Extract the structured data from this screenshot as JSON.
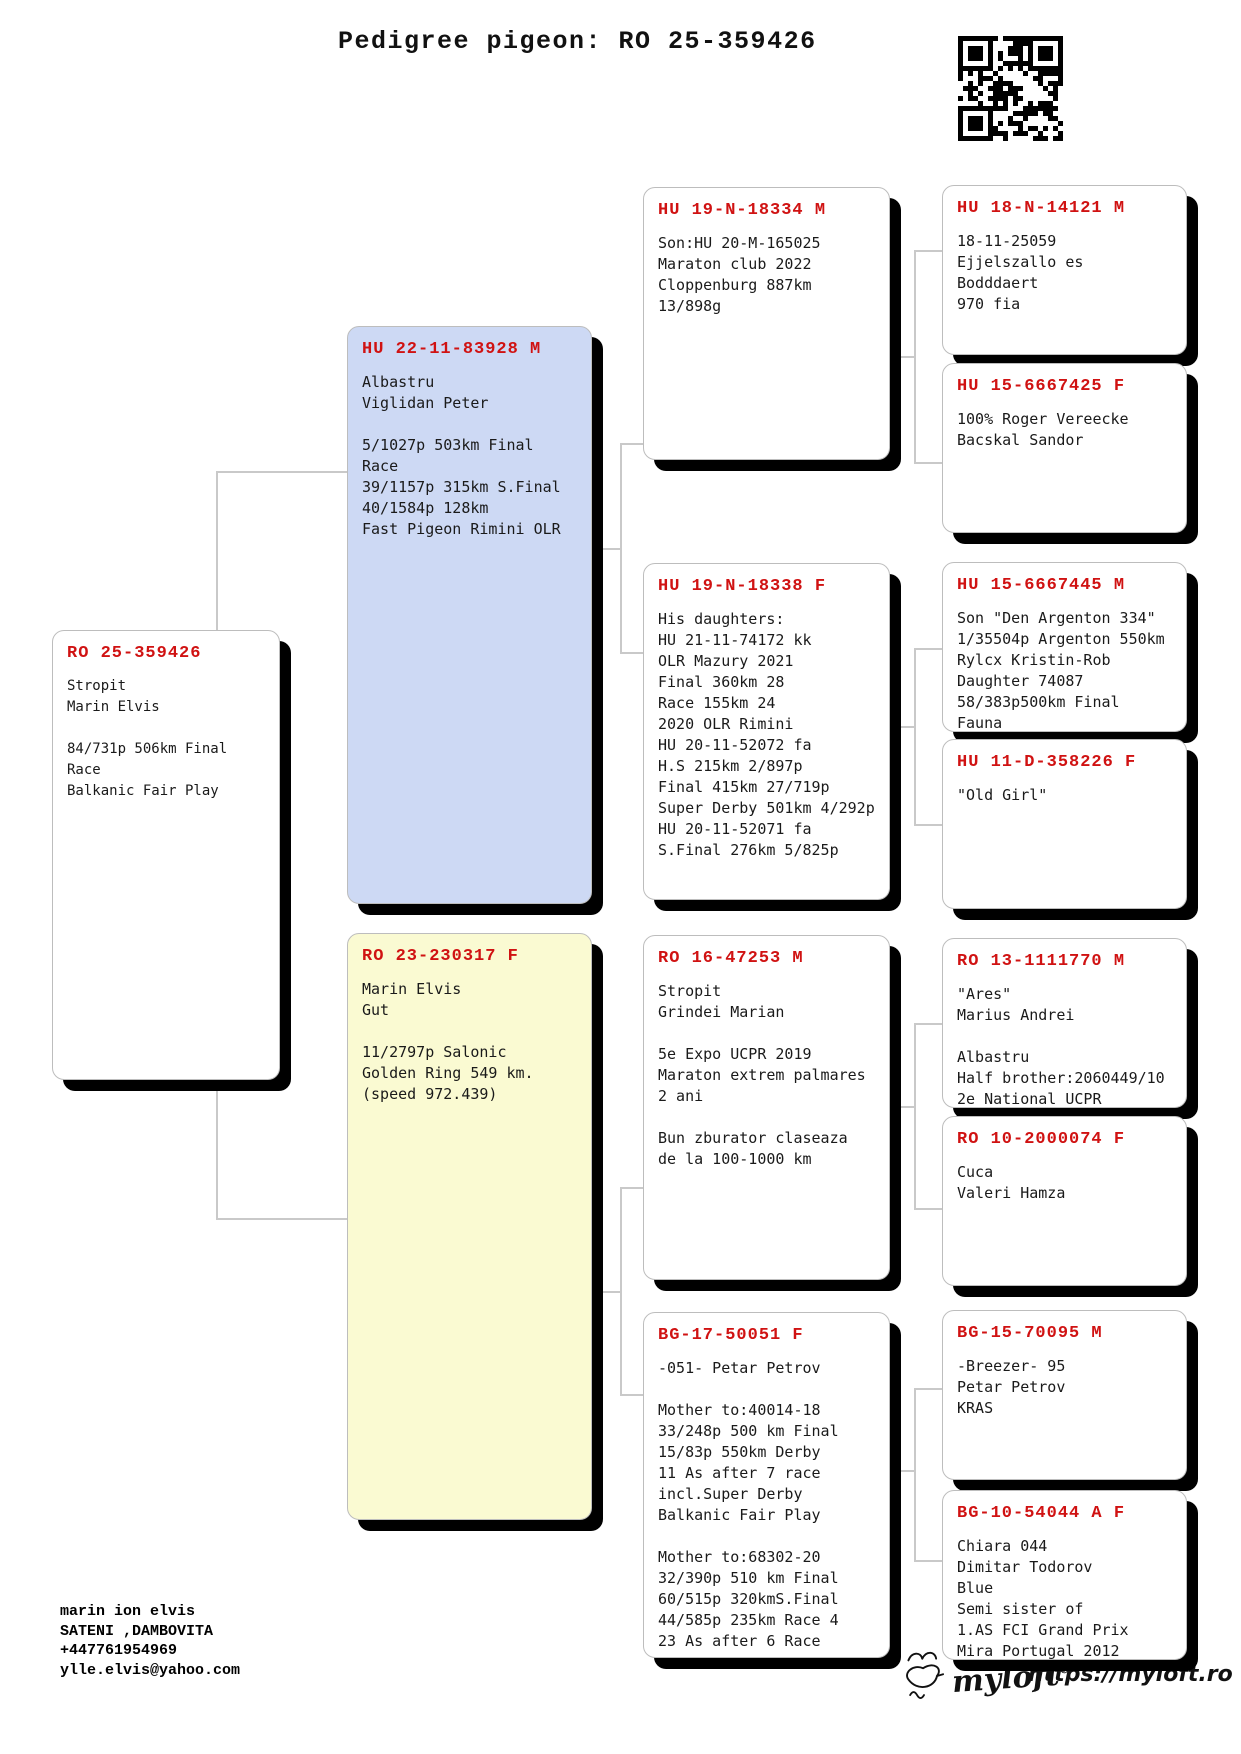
{
  "title": "Pedigree pigeon: RO 25-359426",
  "icons": {
    "qr": "qr-code",
    "brand_bird": "bird-logo"
  },
  "colors": {
    "accent_red": "#d01212",
    "sire_box_bg": "#cdd9f4",
    "dam_box_bg": "#fafad2",
    "box_border": "#bdbdbd",
    "connector": "#c9c9c9",
    "shadow": "#000000"
  },
  "boxes": {
    "subject": {
      "ring": "RO 25-359426",
      "lines": [
        "Stropit",
        "Marin Elvis",
        "",
        "84/731p 506km Final Race",
        "Balkanic Fair Play"
      ]
    },
    "father": {
      "ring": "HU 22-11-83928 M",
      "lines": [
        "Albastru",
        "Viglidan Peter",
        "",
        "5/1027p 503km Final Race",
        "39/1157p 315km S.Final",
        "40/1584p 128km",
        "Fast Pigeon Rimini OLR"
      ]
    },
    "mother": {
      "ring": "RO 23-230317 F",
      "lines": [
        "Marin Elvis",
        "Gut",
        "",
        "11/2797p Salonic",
        "Golden Ring 549 km.",
        "(speed 972.439)"
      ]
    },
    "g3": [
      {
        "ring": "HU 19-N-18334 M",
        "lines": [
          "Son:HU 20-M-165025",
          "Maraton club 2022",
          "Cloppenburg 887km",
          "13/898g"
        ]
      },
      {
        "ring": "HU 19-N-18338 F",
        "lines": [
          "His daughters:",
          "HU 21-11-74172 kk",
          "OLR Mazury 2021",
          "Final 360km 28",
          "Race 155km 24",
          "2020 OLR Rimini",
          "HU 20-11-52072 fa",
          "H.S 215km 2/897p",
          "Final 415km 27/719p",
          "Super Derby 501km 4/292p",
          "HU 20-11-52071 fa",
          "S.Final 276km 5/825p"
        ]
      },
      {
        "ring": "RO 16-47253 M",
        "lines": [
          "Stropit",
          "Grindei Marian",
          "",
          "5e Expo UCPR 2019",
          "Maraton extrem palmares",
          "2 ani",
          "",
          "Bun zburator claseaza",
          "de la 100-1000 km"
        ]
      },
      {
        "ring": "BG-17-50051 F",
        "lines": [
          "-051- Petar Petrov",
          "",
          "Mother to:40014-18",
          "33/248p 500 km Final",
          "15/83p 550km Derby",
          "11 As after 7 race",
          "incl.Super Derby",
          "Balkanic Fair Play",
          "",
          "Mother to:68302-20",
          "32/390p 510 km Final",
          "60/515p 320kmS.Final",
          "44/585p 235km Race 4",
          "23 As after 6 Race"
        ]
      }
    ],
    "g4": [
      {
        "ring": "HU 18-N-14121 M",
        "lines": [
          "18-11-25059",
          "Ejjelszallo es Bodddaert",
          "970 fia"
        ]
      },
      {
        "ring": "HU 15-6667425 F",
        "lines": [
          "100% Roger Vereecke",
          "Bacskal Sandor"
        ]
      },
      {
        "ring": "HU 15-6667445 M",
        "lines": [
          "Son \"Den Argenton 334\"",
          "1/35504p Argenton 550km",
          "Rylcx Kristin-Rob",
          "Daughter 74087",
          "58/383p500km Final Fauna"
        ]
      },
      {
        "ring": "HU 11-D-358226 F",
        "lines": [
          "\"Old Girl\""
        ]
      },
      {
        "ring": "RO 13-1111770 M",
        "lines": [
          "\"Ares\"",
          "Marius Andrei",
          "",
          "Albastru",
          "Half brother:2060449/10",
          "2e National UCPR"
        ]
      },
      {
        "ring": "RO 10-2000074 F",
        "lines": [
          "Cuca",
          "Valeri Hamza"
        ]
      },
      {
        "ring": "BG-15-70095 M",
        "lines": [
          "-Breezer- 95",
          "Petar Petrov",
          "KRAS"
        ]
      },
      {
        "ring": "BG-10-54044 A F",
        "lines": [
          "Chiara 044",
          "Dimitar Todorov",
          "Blue",
          "Semi sister of",
          "1.AS FCI Grand Prix",
          "Mira Portugal 2012"
        ]
      }
    ]
  },
  "footer": {
    "owner_lines": [
      "marin ion elvis",
      "SATENI ,DAMBOVITA",
      "+447761954969",
      "ylle.elvis@yahoo.com"
    ],
    "brand": "myloft",
    "brand_reg": "®",
    "url": "https://myloft.ro"
  }
}
